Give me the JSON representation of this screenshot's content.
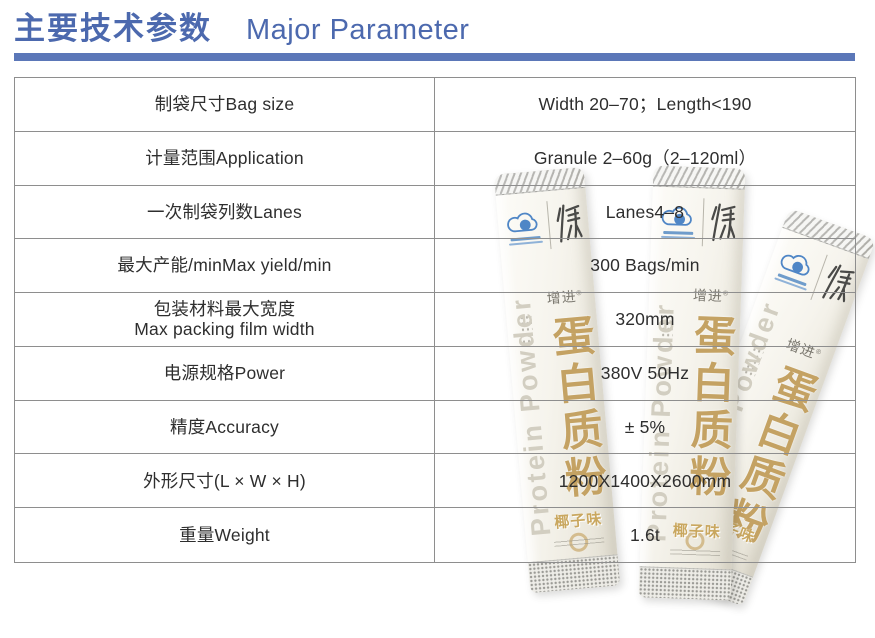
{
  "header": {
    "title_zh": "主要技术参数",
    "title_en": "Major Parameter"
  },
  "table": {
    "rows": [
      {
        "label": "制袋尺寸Bag size",
        "value": "Width 20–70；Length<190"
      },
      {
        "label": "计量范围Application",
        "value": "Granule 2–60g（2–120ml）"
      },
      {
        "label": "一次制袋列数Lanes",
        "value": "Lanes4–8"
      },
      {
        "label": "最大产能/minMax yield/min",
        "value": "300 Bags/min"
      },
      {
        "label": "包装材料最大宽度",
        "label2": "Max packing film width",
        "value": "320mm"
      },
      {
        "label": "电源规格Power",
        "value": "380V 50Hz"
      },
      {
        "label": "精度Accuracy",
        "value": "± 5%"
      },
      {
        "label": "外形尺寸(L × W × H)",
        "value": "1200X1400X2600mm"
      },
      {
        "label": "重量Weight",
        "value": "1.6t"
      }
    ]
  },
  "product_packs": {
    "brand": "增进",
    "name_zh": "蛋白质粉",
    "name_en": "Protein Powder",
    "flavor": "椰子味"
  },
  "colors": {
    "accent_text": "#4c69ae",
    "accent_bar": "#5b77b8",
    "table_border": "#8e8e8e",
    "pack_gold": "#c4a263",
    "logo_blue": "#4f86c6"
  }
}
